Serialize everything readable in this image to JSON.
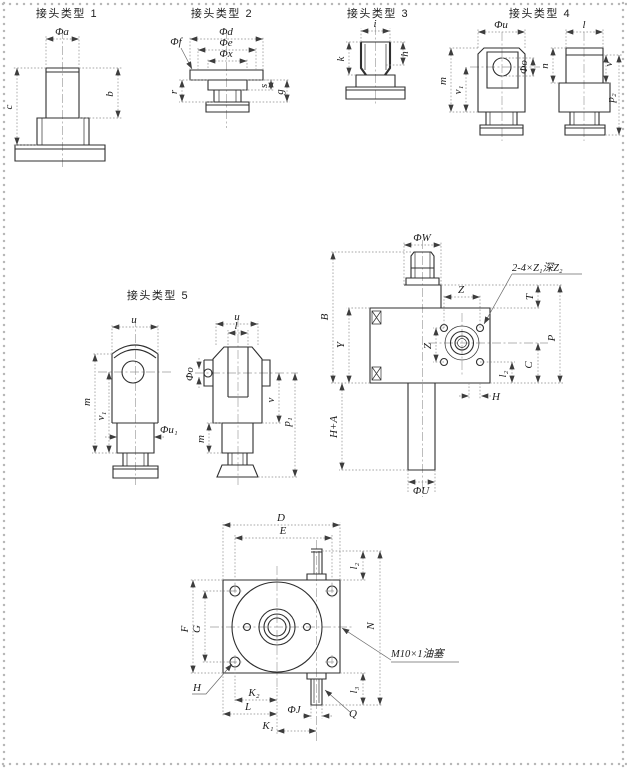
{
  "page": {
    "background": "#ffffff",
    "ink": "#2f2f2f",
    "dim_color": "#8a8a8a"
  },
  "joint1": {
    "title": "接头类型 1",
    "dim_phi_a": "Φa",
    "dim_b": "b",
    "dim_c": "c"
  },
  "joint2": {
    "title": "接头类型 2",
    "dim_phi_d": "Φd",
    "dim_phi_e": "Φe",
    "dim_phi_x": "Φx",
    "dim_phi_f": "Φf",
    "dim_r": "r",
    "dim_s": "s",
    "dim_g": "g"
  },
  "joint3": {
    "title": "接头类型 3",
    "dim_i": "i",
    "dim_h": "h",
    "dim_k": "k"
  },
  "joint4": {
    "title": "接头类型 4",
    "dim_phi_u": "Φu",
    "dim_m": "m",
    "dim_v1": "v₁",
    "dim_phi_o": "Φo",
    "dim_l": "l",
    "dim_n": "n",
    "dim_v": "v",
    "dim_p2": "p₂"
  },
  "joint5": {
    "title": "接头类型 5",
    "left": {
      "dim_u": "u",
      "dim_m": "m",
      "dim_v1": "v₁",
      "dim_phi_u1": "Φu₁"
    },
    "right": {
      "dim_u": "u",
      "dim_l": "l",
      "dim_phi_o": "Φo",
      "dim_v": "v",
      "dim_m": "m",
      "dim_p1": "p₁"
    }
  },
  "cylinder": {
    "dim_phi_w": "ΦW",
    "dim_b": "B",
    "dim_y": "Y",
    "dim_h_plus_a": "H+A",
    "dim_phi_u": "ΦU",
    "dim_z_horizontal": "Z",
    "dim_z_vertical": "Z",
    "dim_t": "T",
    "dim_p": "P",
    "dim_c": "C",
    "dim_l2": "l₂",
    "dim_h": "H",
    "port_callout": "2-4×Z₁深Z₂"
  },
  "flange": {
    "dim_d": "D",
    "dim_e": "E",
    "dim_f": "F",
    "dim_g": "G",
    "dim_n": "N",
    "dim_l2": "l₂",
    "dim_l3": "l₃",
    "dim_h": "H",
    "dim_k2": "K₂",
    "dim_l": "L",
    "dim_phi_j": "ΦJ",
    "dim_k1": "K₁",
    "dim_q": "Q",
    "plug_callout": "M10×1油塞"
  }
}
